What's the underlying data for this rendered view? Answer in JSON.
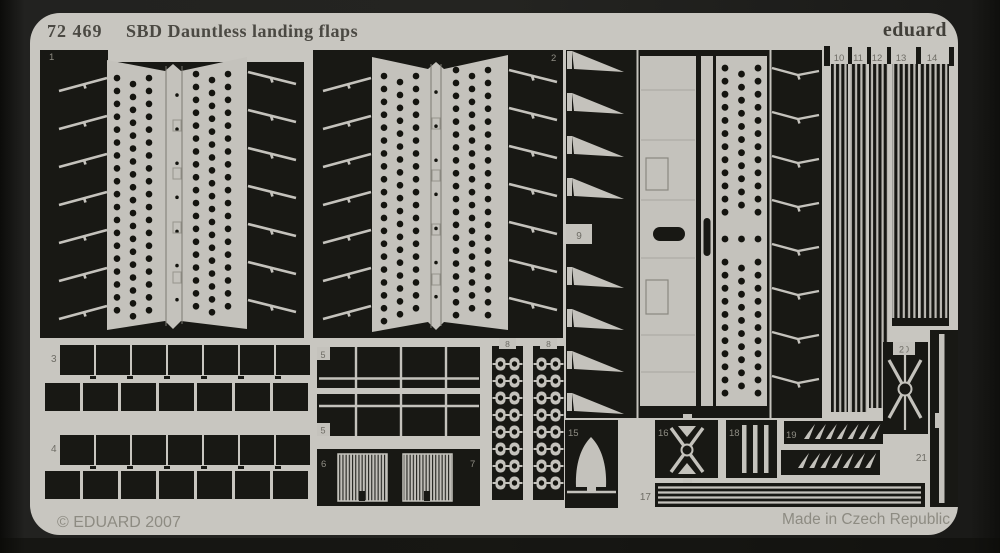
{
  "product": {
    "catalog_number": "72 469",
    "title": "SBD Dauntless landing flaps",
    "brand": "eduard",
    "copyright": "© EDUARD 2007",
    "made_in": "Made in Czech Republic"
  },
  "colors": {
    "background": "#1e1e1b",
    "sheet": "#c8c6c0",
    "etched": "#181814",
    "title_text": "#4b4943",
    "brand_text": "#413f39",
    "footer_text": "#8d8b82",
    "label_dark": "#6e6c65",
    "label_light": "#8f8d84"
  },
  "part_labels": {
    "part1": "1",
    "part2": "2",
    "part3": "3",
    "part4": "4",
    "part5a": "5",
    "part5b": "5",
    "part6": "6",
    "part7": "7",
    "part8a": "8",
    "part8b": "8",
    "part9": "9",
    "part10": "10",
    "part11": "11",
    "part12": "12",
    "part13": "13",
    "part14": "14",
    "part15": "15",
    "part16": "16",
    "part17": "17",
    "part18": "18",
    "part19": "19",
    "part20": "20",
    "part21": "21"
  }
}
